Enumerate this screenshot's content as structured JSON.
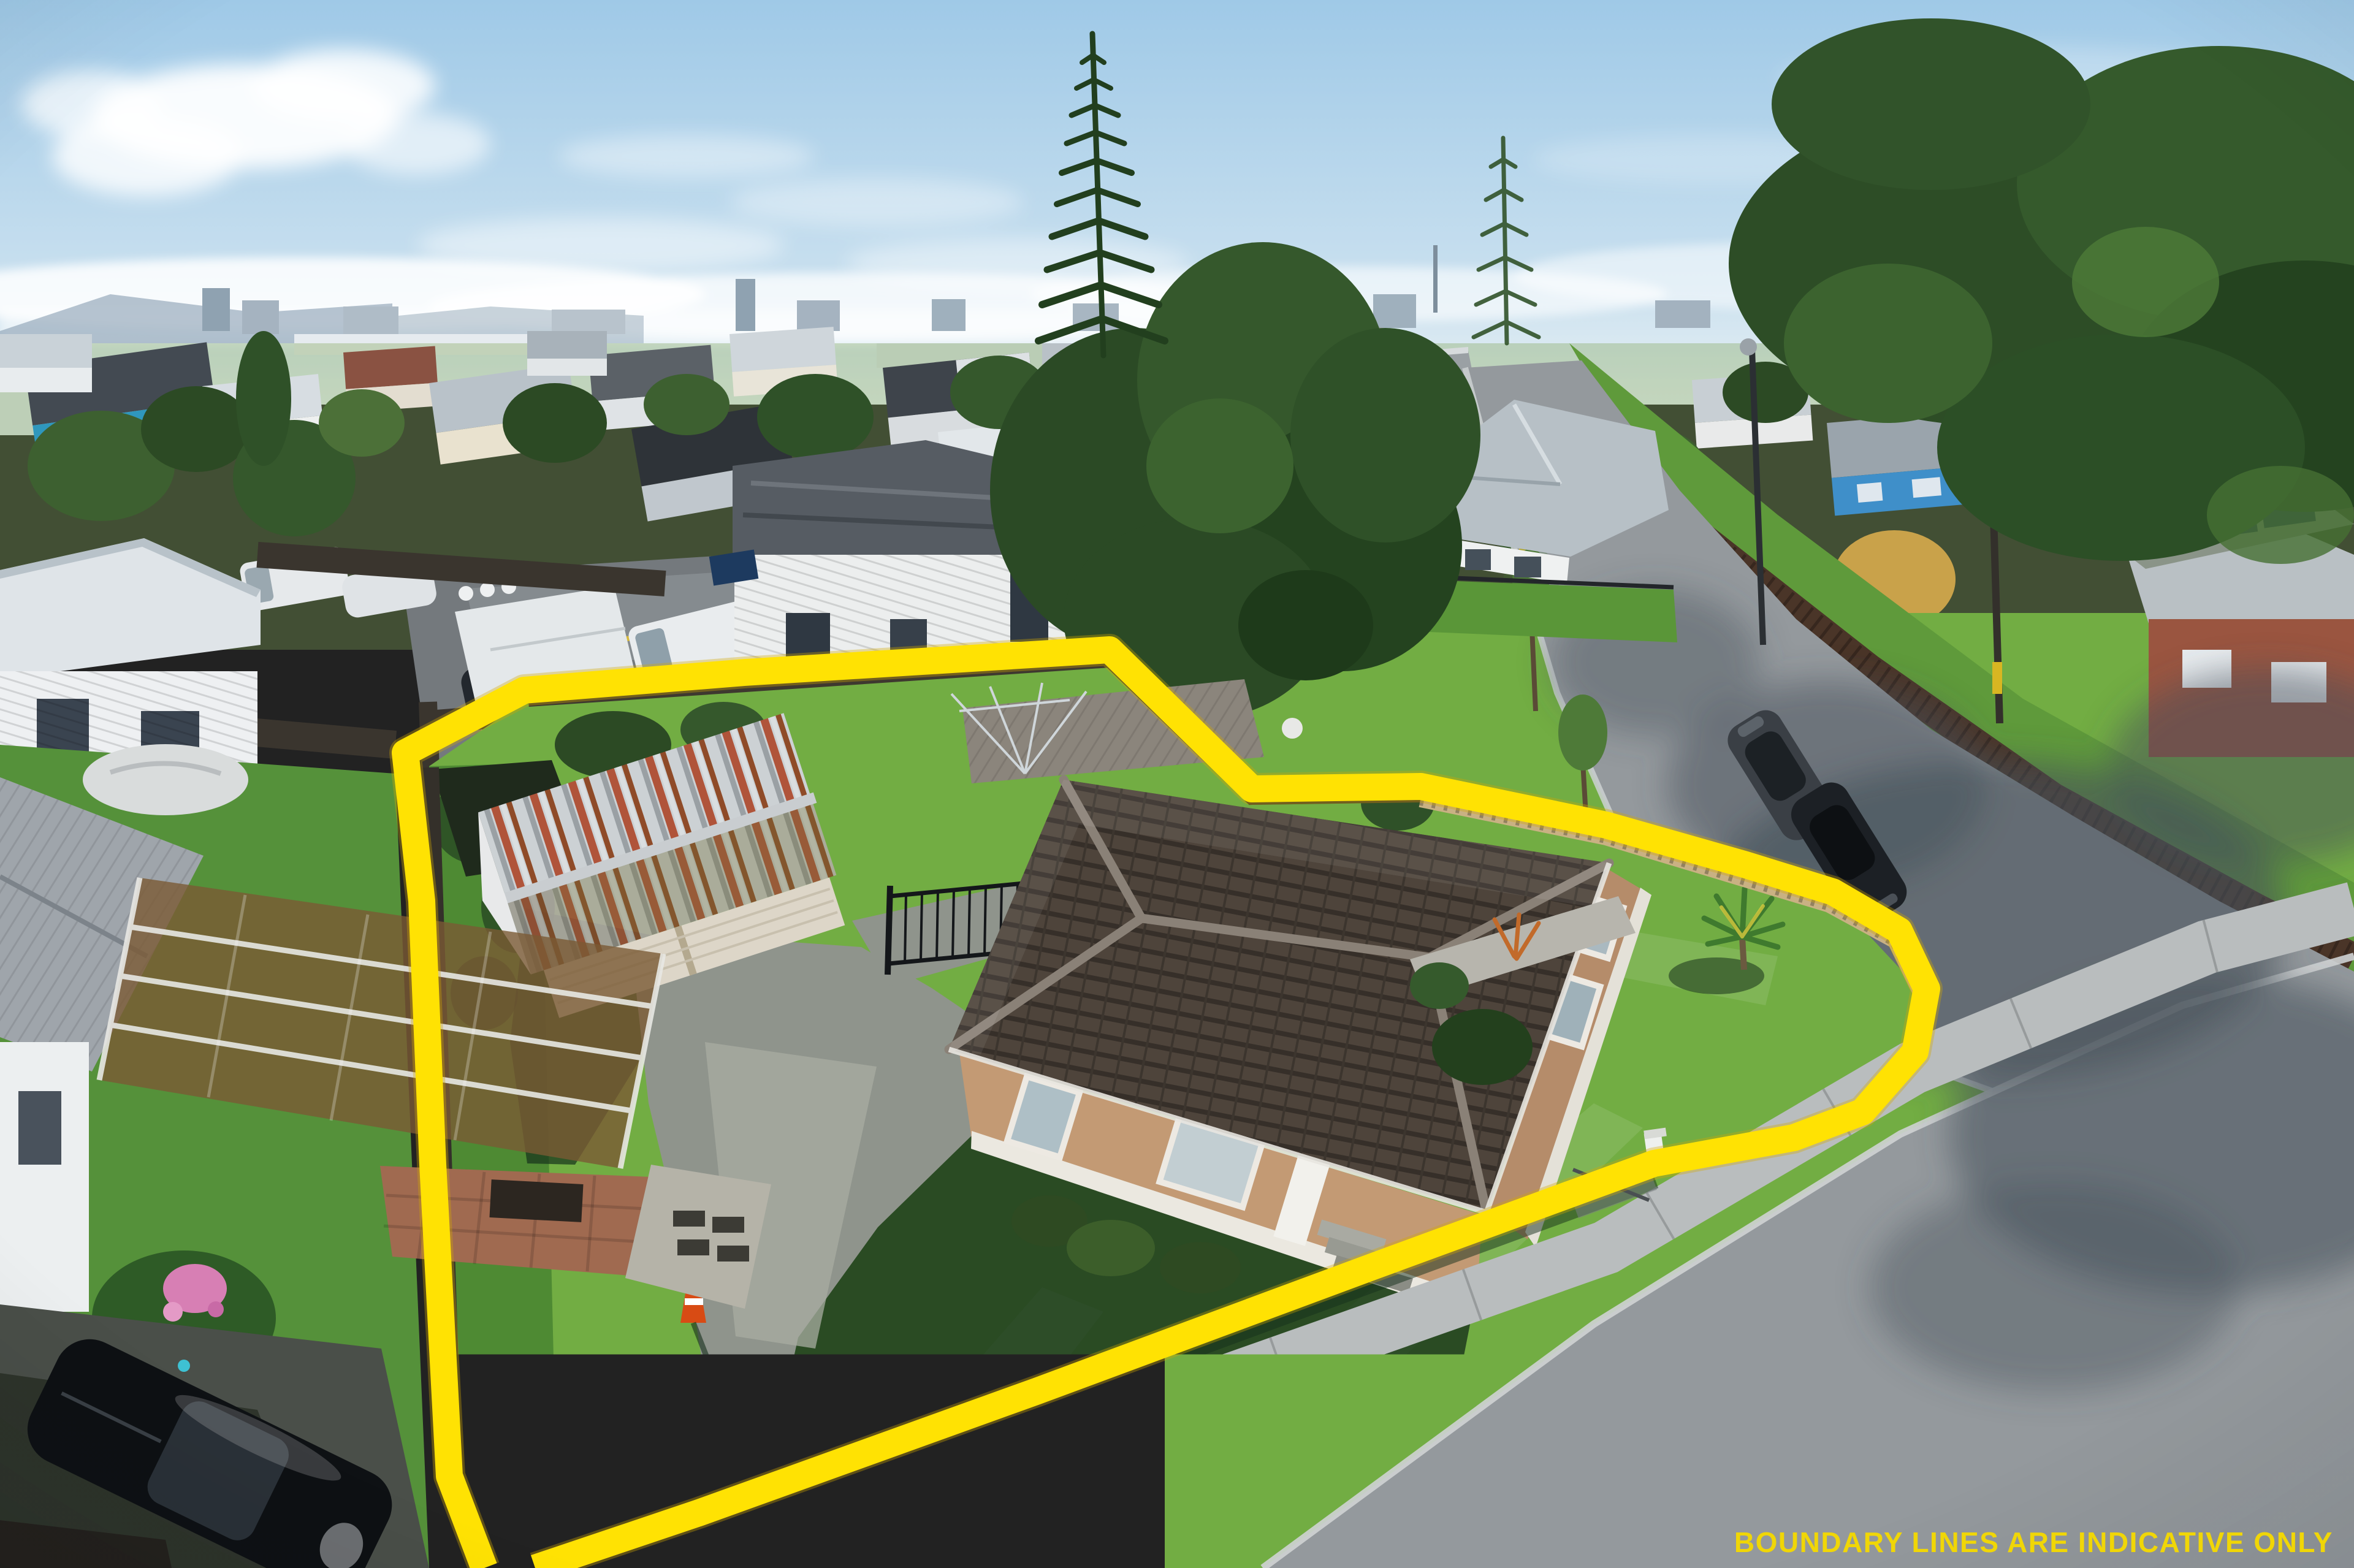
{
  "overlay": {
    "disclaimer": "BOUNDARY LINES ARE INDICATIVE ONLY",
    "disclaimer_color": "#F0D607",
    "boundary_color": "#FFE203"
  },
  "scene": {
    "type": "aerial-drone-photo",
    "subject": "single-storey weatherboard house on corner section with detached garage, lawns and picket fence, yellow indicative boundary overlay",
    "palette": {
      "sky_top": "#9fc9e7",
      "sky_horizon": "#e9f1f4",
      "cloud": "#ffffff",
      "hill_haze": "#879db0",
      "city_haze": "#a5b3c0",
      "grass_sunlit": "#72ad43",
      "grass_bright": "#8ec455",
      "grass_shadow": "#16301b",
      "road": "#94999d",
      "road_shadow": "#46505a",
      "footpath": "#b9bdbe",
      "kerb": "#cfd3d4",
      "driveway": "#8f948c",
      "asphalt_court": "#74797d",
      "roof_main": "#4a4038",
      "roof_ridge": "#8a8177",
      "wall_main": "#c39a74",
      "wall_base": "#ebe8e0",
      "garage_steel": "#ccd1d4",
      "garage_rust": "#a9562f",
      "garage_door": "#ddd6c8",
      "picket_fence": "#c9b183",
      "dark_fence": "#3a352e",
      "far_fence": "#4a3528",
      "tree_dark": "#24431f",
      "tree_mid": "#35582c",
      "tree_light": "#4e7a38",
      "tree_autumn": "#c9a24a",
      "white_house": "#eef0f1",
      "metal_roof": "#d9dee1",
      "blue_house": "#3f8fc9",
      "brick_house": "#9a5540",
      "car_black": "#0e1114",
      "van_white": "#e9ecee"
    }
  }
}
